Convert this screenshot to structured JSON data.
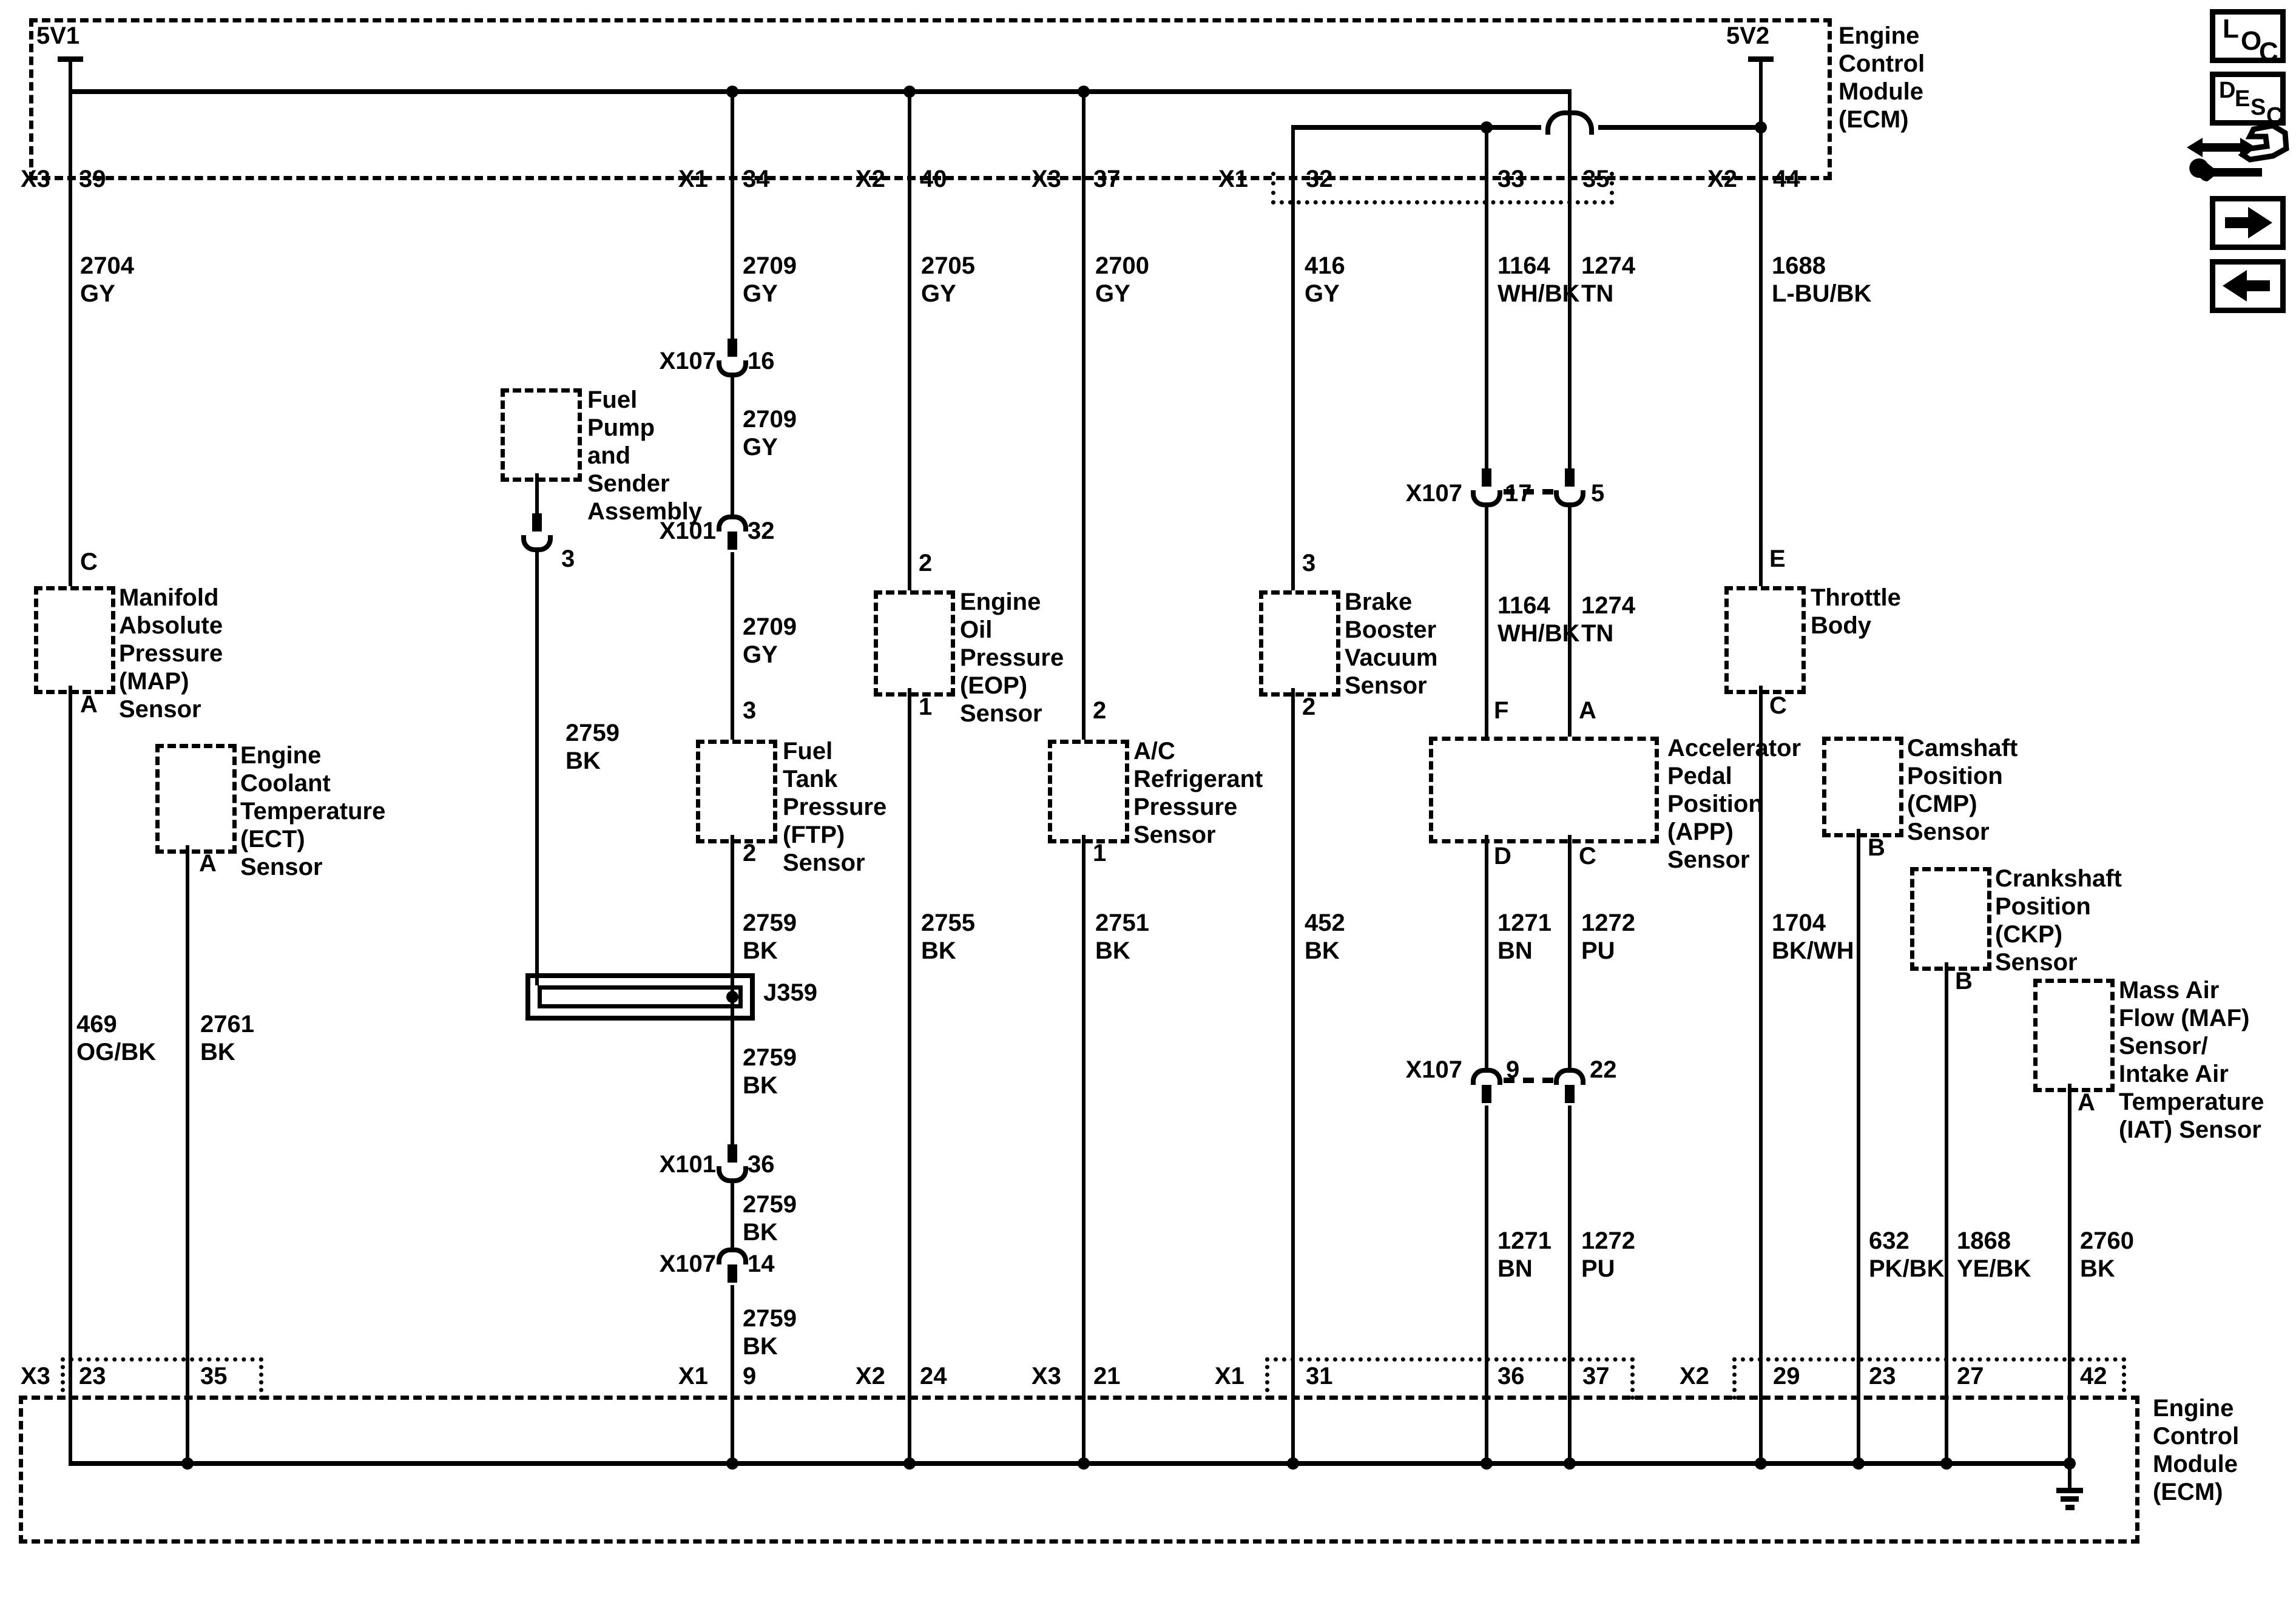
{
  "title_blocks": {
    "ecm": "Engine\nControl\nModule\n(ECM)"
  },
  "power": {
    "v1": "5V1",
    "v2": "5V2"
  },
  "connector_names": {
    "x1": "X1",
    "x2": "X2",
    "x3": "X3",
    "x101": "X101",
    "x107": "X107"
  },
  "pins": {
    "p1": "1",
    "p2": "2",
    "p3": "3",
    "p5": "5",
    "p9": "9",
    "p14": "14",
    "p16": "16",
    "p17": "17",
    "p21": "21",
    "p22": "22",
    "p23": "23",
    "p24": "24",
    "p27": "27",
    "p29": "29",
    "p31": "31",
    "p32": "32",
    "p33": "33",
    "p34": "34",
    "p35": "35",
    "p36": "36",
    "p37": "37",
    "p39": "39",
    "p40": "40",
    "p42": "42",
    "p44": "44",
    "pA": "A",
    "pB": "B",
    "pC": "C",
    "pD": "D",
    "pE": "E",
    "pF": "F"
  },
  "wires": {
    "w2704": "2704\nGY",
    "w2709": "2709\nGY",
    "w2705": "2705\nGY",
    "w2700": "2700\nGY",
    "w416": "416\nGY",
    "w1164": "1164\nWH/BK",
    "w1274": "1274\nTN",
    "w1688": "1688\nL-BU/BK",
    "w2759": "2759\nBK",
    "w2755": "2755\nBK",
    "w2751": "2751\nBK",
    "w452": "452\nBK",
    "w1271": "1271\nBN",
    "w1272": "1272\nPU",
    "w1704": "1704\nBK/WH",
    "w469": "469\nOG/BK",
    "w2761": "2761\nBK",
    "w632": "632\nPK/BK",
    "w1868": "1868\nYE/BK",
    "w2760": "2760\nBK"
  },
  "splices": {
    "j359": "J359"
  },
  "components": {
    "fuel_pump": "Fuel\nPump\nand\nSender\nAssembly",
    "map": "Manifold\nAbsolute\nPressure\n(MAP)\nSensor",
    "ect": "Engine\nCoolant\nTemperature\n(ECT)\nSensor",
    "ftp": "Fuel\nTank\nPressure\n(FTP)\nSensor",
    "eop": "Engine\nOil\nPressure\n(EOP)\nSensor",
    "ac": "A/C\nRefrigerant\nPressure\nSensor",
    "brake": "Brake\nBooster\nVacuum\nSensor",
    "app": "Accelerator\nPedal\nPosition\n(APP)\nSensor",
    "throttle": "Throttle\nBody",
    "cmp": "Camshaft\nPosition\n(CMP)\nSensor",
    "ckp": "Crankshaft\nPosition\n(CKP)\nSensor",
    "maf": "Mass Air\nFlow (MAF)\nSensor/\nIntake Air\nTemperature\n(IAT) Sensor"
  },
  "nav_icons": {
    "loc": [
      "L",
      "O",
      "C"
    ],
    "desc": [
      "D",
      "E",
      "S",
      "C"
    ]
  }
}
